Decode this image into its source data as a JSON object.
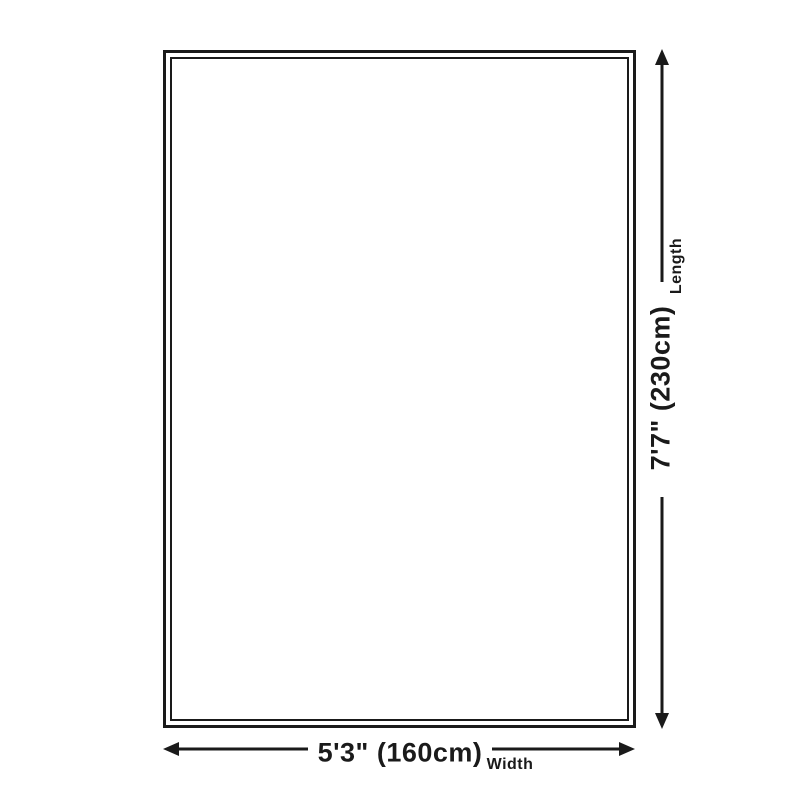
{
  "diagram": {
    "name": "rug-size-diagram",
    "length": {
      "label": "Length",
      "value": "7'7\" (230cm)"
    },
    "width": {
      "label": "Width",
      "value": "5'3\" (160cm)"
    },
    "colors": {
      "line": "#1a1a1a",
      "background": "#ffffff"
    }
  }
}
